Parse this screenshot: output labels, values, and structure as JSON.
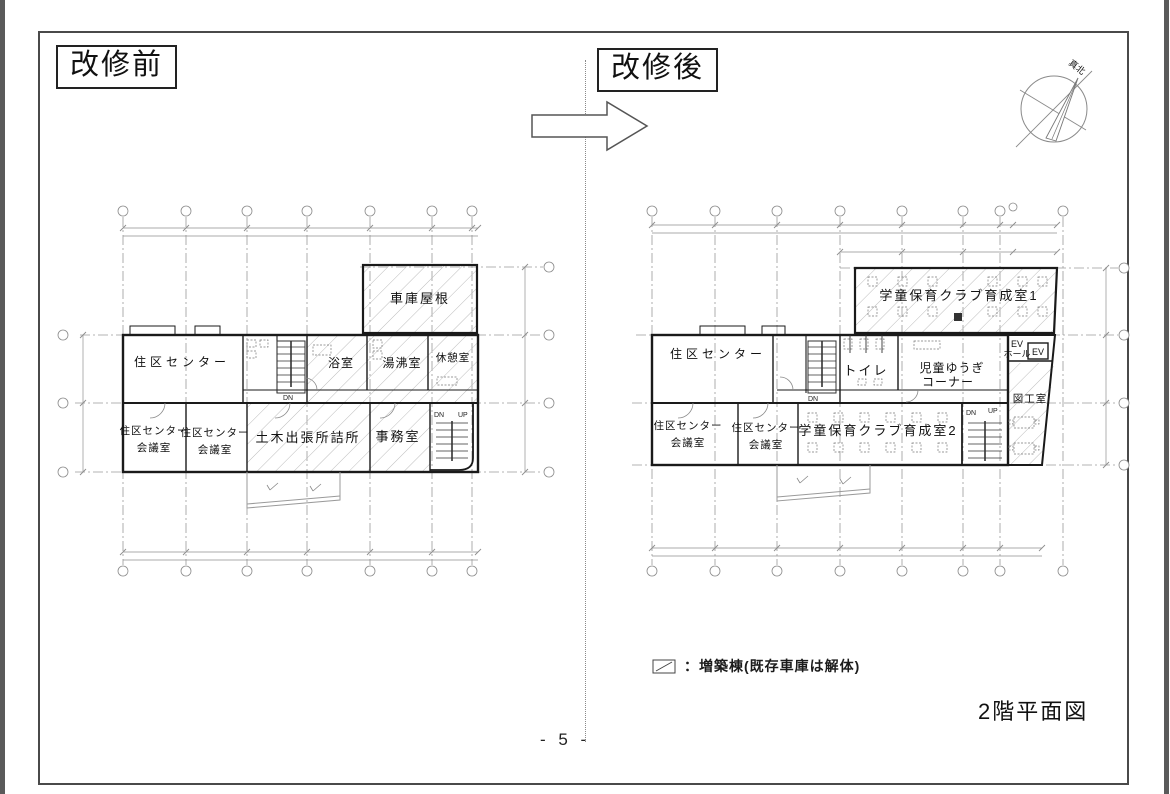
{
  "header": {
    "before_title": "改修前",
    "after_title": "改修後"
  },
  "compass": {
    "label": "真北"
  },
  "before_plan": {
    "rooms": {
      "garage_roof": "車庫屋根",
      "district_center": "住区センター",
      "bathroom": "浴室",
      "hot_water_room": "湯沸室",
      "rest_room": "休憩室",
      "meeting1_l1": "住区センター",
      "meeting1_l2": "会議室",
      "meeting2_l1": "住区センター",
      "meeting2_l2": "会議室",
      "civil_office": "土木出張所詰所",
      "office": "事務室"
    },
    "stairs": {
      "dn_mid": "DN",
      "dn": "DN",
      "up": "UP"
    }
  },
  "after_plan": {
    "rooms": {
      "gakudo1": "学童保育クラブ育成室1",
      "district_center": "住区センター",
      "toilet": "トイレ",
      "play_corner_l1": "児童ゆうぎ",
      "play_corner_l2": "コーナー",
      "ev_hall_l1": "EV",
      "ev_hall_l2": "ホール",
      "ev": "EV",
      "craft_room": "図工室",
      "meeting1_l1": "住区センター",
      "meeting1_l2": "会議室",
      "meeting2_l1": "住区センター",
      "meeting2_l2": "会議室",
      "gakudo2": "学童保育クラブ育成室2"
    },
    "stairs": {
      "dn_mid": "DN",
      "dn": "DN",
      "up": "UP"
    }
  },
  "legend": {
    "text": "：増築棟(既存車庫は解体)"
  },
  "footer": {
    "drawing_title": "2階平面図",
    "page_number": "- 5 -"
  }
}
